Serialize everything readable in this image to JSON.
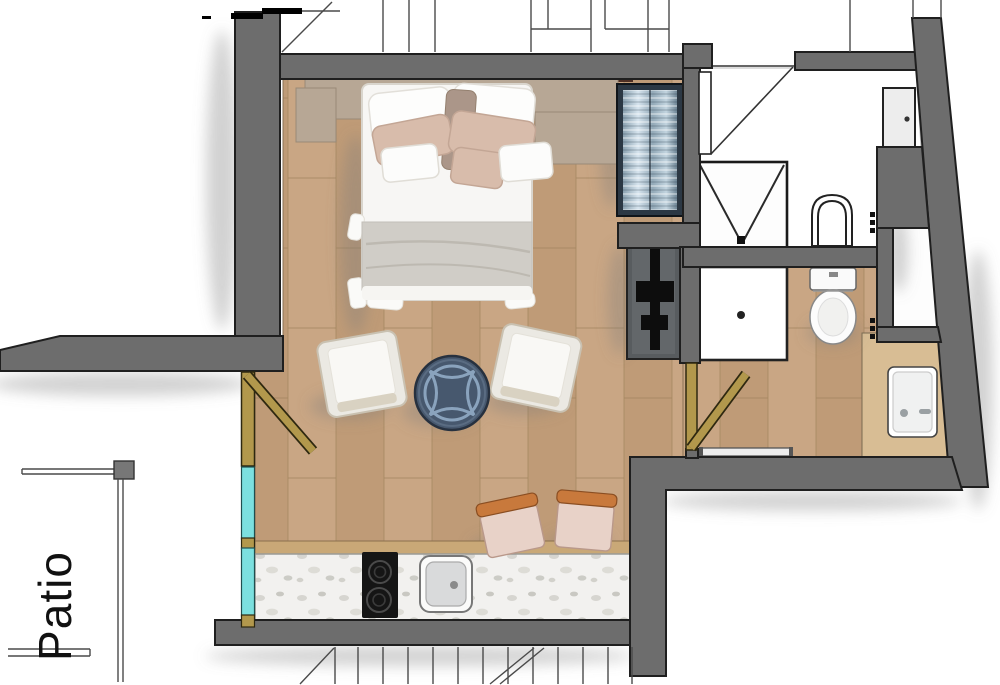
{
  "labels": {
    "patio": "Patio"
  },
  "colors": {
    "wall": "#6d6d6d",
    "wall-outline": "#1f1f1f",
    "floor-wood": "#c9a684",
    "floor-wood-2": "#bf9b77",
    "plank-line": "#a3865f",
    "floor-tan": "#d8bd94",
    "glass-teal": "#7ce0df",
    "door-gold": "#b2984c",
    "wardrobe-dark": "#2c3844",
    "table-navy": "#47586e",
    "table-ring": "#8aa3bd",
    "counter-marble": "#f2f1ef",
    "counter-edge": "#c9a877",
    "stool-orange": "#c8793c",
    "stool-seat": "#e8d2c8",
    "cabinet-gray": "#585c5f",
    "bed-white": "#f7f6f4",
    "pillow-beige": "#d8bcab",
    "blanket-gray": "#d0cdc7",
    "headboard-tan": "#b7a795",
    "headboard-trim": "#4e2f24",
    "fixture-white": "#ffffff",
    "line-thin": "#4a4a4a"
  }
}
